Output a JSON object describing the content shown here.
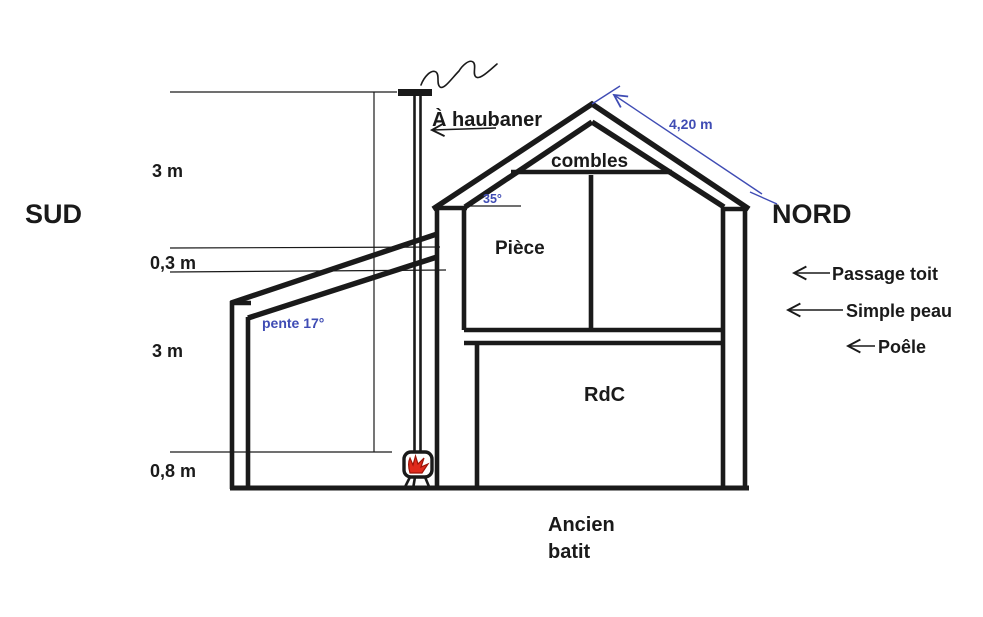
{
  "diagram": {
    "orientation": {
      "left": "SUD",
      "right": "NORD"
    },
    "interior_labels": {
      "attic": "combles",
      "upper_room": "Pièce",
      "ground_floor": "RdC",
      "old_building_line1": "Ancien",
      "old_building_line2": "batit"
    },
    "chimney_note": "À haubaner",
    "dimensions": {
      "upper_height": "3 m",
      "roof_offset": "0,3 m",
      "lower_height": "3 m",
      "stove_height": "0,8 m",
      "roof_slope_length": "4,20 m",
      "roof_angle": "35°",
      "leanto_slope": "pente 17°"
    },
    "right_annotations": [
      {
        "label": "Passage toit"
      },
      {
        "label": "Simple peau"
      },
      {
        "label": "Poêle"
      }
    ],
    "colors": {
      "ink": "#1a1a1a",
      "accent_blue": "#3f4cb4",
      "flame_red": "#e02a1c"
    }
  }
}
